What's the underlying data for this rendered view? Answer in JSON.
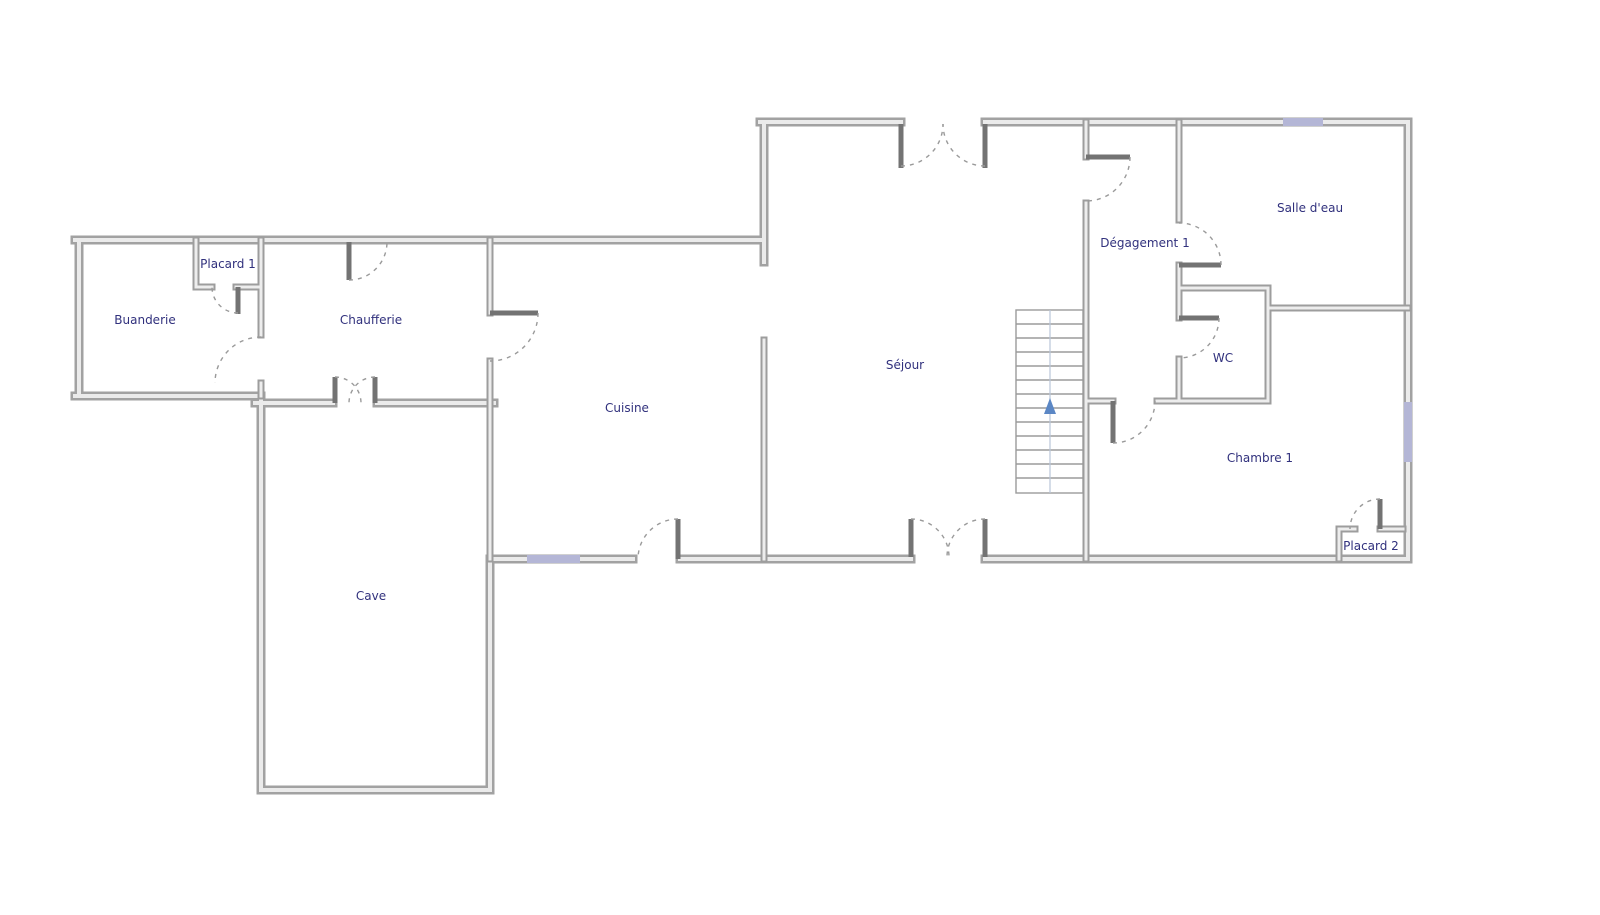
{
  "plan": {
    "type": "floor-plan",
    "background": "#ffffff",
    "rooms": [
      {
        "id": "buanderie",
        "label": "Buanderie"
      },
      {
        "id": "placard-1",
        "label": "Placard 1"
      },
      {
        "id": "chaufferie",
        "label": "Chaufferie"
      },
      {
        "id": "cuisine",
        "label": "Cuisine"
      },
      {
        "id": "cave",
        "label": "Cave"
      },
      {
        "id": "sejour",
        "label": "Séjour"
      },
      {
        "id": "degagement-1",
        "label": "Dégagement 1"
      },
      {
        "id": "salle-deau",
        "label": "Salle d'eau"
      },
      {
        "id": "wc",
        "label": "WC"
      },
      {
        "id": "chambre-1",
        "label": "Chambre 1"
      },
      {
        "id": "placard-2",
        "label": "Placard 2"
      }
    ],
    "stairs": {
      "treads": 14,
      "direction_arrow": "up"
    },
    "windows_count": 3,
    "colors": {
      "wall": "#a2a2a2",
      "wall_core": "#ebebeb",
      "door_leaf": "#737373",
      "door_arc": "#9a9a9a",
      "window": "#b4b6d6",
      "label": "#31317d",
      "stair_arrow": "#5b87c5"
    }
  }
}
